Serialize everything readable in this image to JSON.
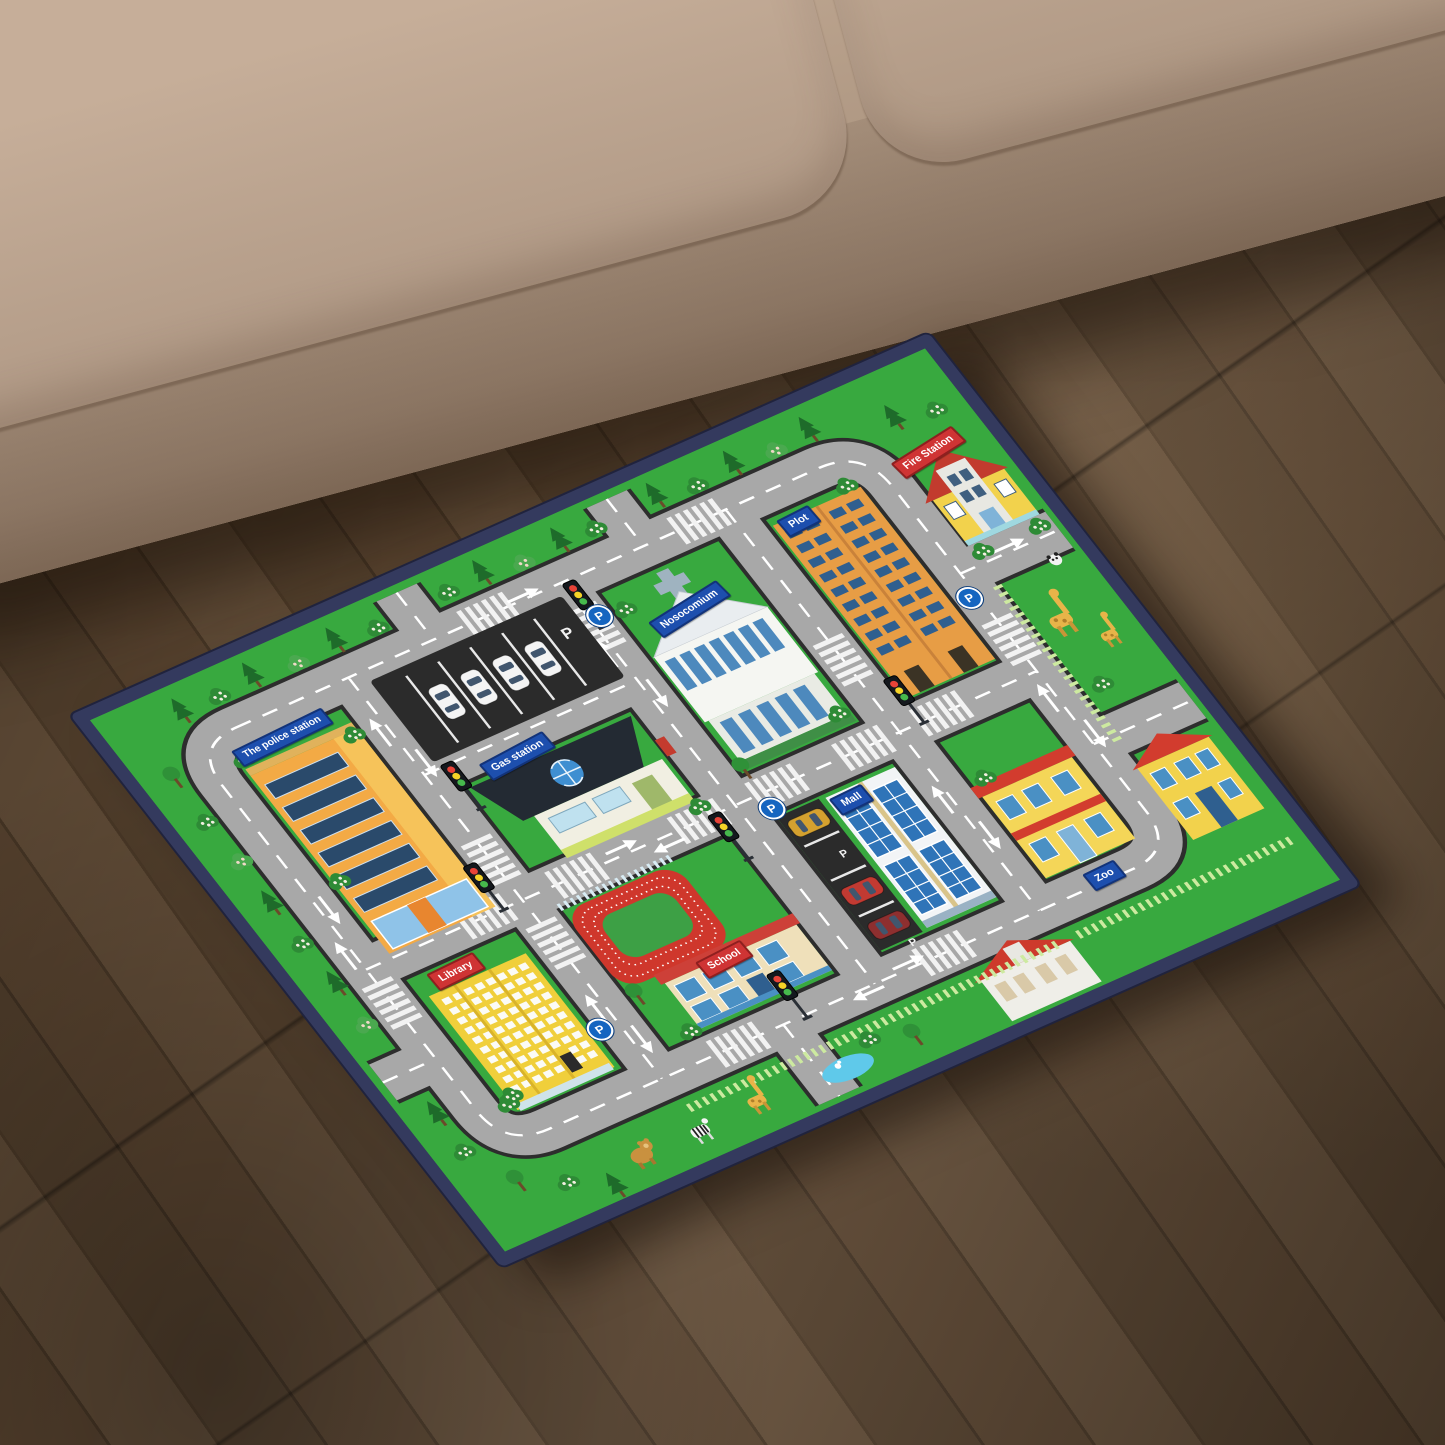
{
  "scene": {
    "type": "product photo",
    "setting": "kids city road play rug lying at an angle on a dark brown wood plank floor beside a beige fabric sofa"
  },
  "rug": {
    "labels": {
      "police_station": "The police station",
      "gas_station": "Gas station",
      "hospital": "Nosocomium",
      "plot": "Plot",
      "fire_station": "Fire Station",
      "mall": "Mall",
      "zoo": "Zoo",
      "school": "School",
      "library": "Library",
      "parking_letter": "P"
    },
    "colors": {
      "grass_green": "#38a93f",
      "road_gray": "#a8a8a8",
      "road_edge": "#2d2d2d",
      "border_navy": "#343a5e",
      "sign_blue": "#1d4fae",
      "sign_red": "#cf3434",
      "track_red": "#cf372c",
      "pond_blue": "#5fc9ea",
      "parking_asphalt": "#2b2b2b"
    }
  },
  "room": {
    "sofa_fabric": "#c0a892",
    "floor_wood": "#57432f"
  }
}
